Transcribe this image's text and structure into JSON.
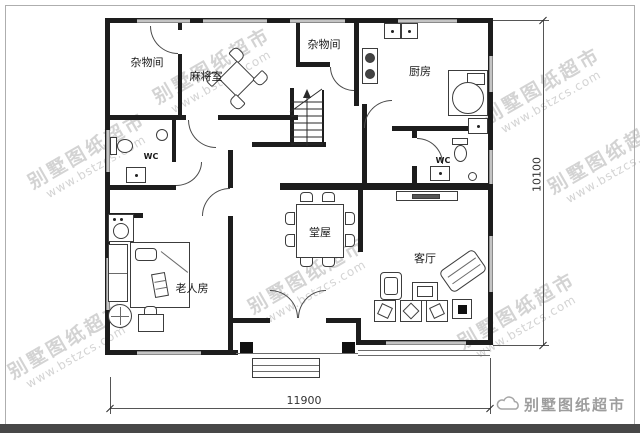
{
  "brand": {
    "watermark_text": "别墅图纸超市",
    "watermark_url": "www.bstzcs.com",
    "logo_text": "别墅图纸超市"
  },
  "rooms": [
    {
      "id": "storage-1",
      "label": "杂物间"
    },
    {
      "id": "mahjong-room",
      "label": "麻将室"
    },
    {
      "id": "storage-2",
      "label": "杂物间"
    },
    {
      "id": "kitchen",
      "label": "厨房"
    },
    {
      "id": "wc-left",
      "label": "WC"
    },
    {
      "id": "wc-right",
      "label": "WC"
    },
    {
      "id": "main-hall",
      "label": "堂屋"
    },
    {
      "id": "living-room",
      "label": "客厅"
    },
    {
      "id": "elder-bedroom",
      "label": "老人房"
    }
  ],
  "dimensions": {
    "width": "11900",
    "height": "10100"
  },
  "colors": {
    "wall": "#1d1d1d",
    "watermark": "#a8a8a8",
    "footer_bar": "#474747",
    "dimension": "#555555"
  }
}
